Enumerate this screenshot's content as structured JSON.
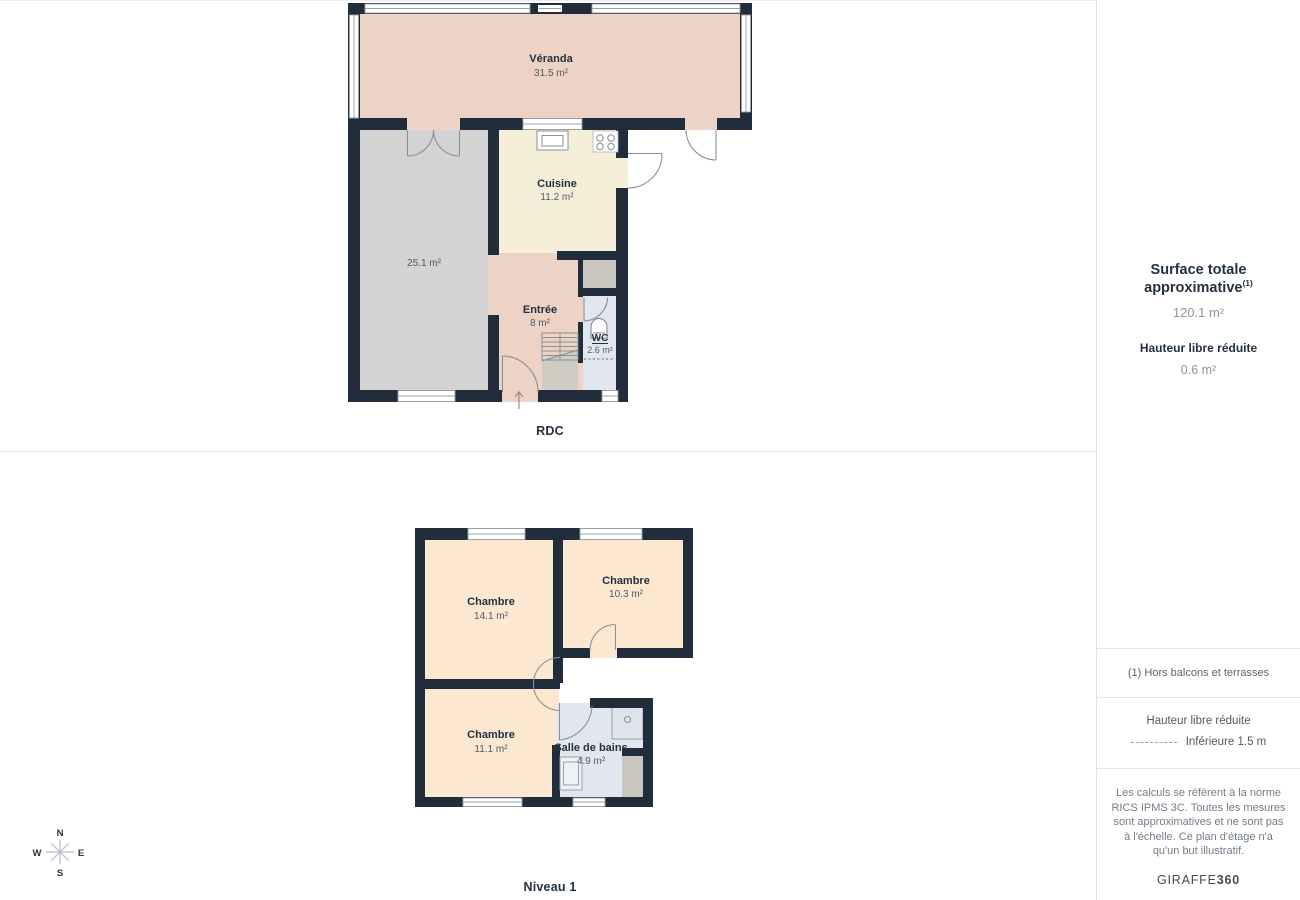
{
  "floors": {
    "rdc": {
      "label": "RDC",
      "rooms": {
        "veranda": {
          "name": "Véranda",
          "area": "31.5 m²"
        },
        "cuisine": {
          "name": "Cuisine",
          "area": "11.2 m²"
        },
        "living": {
          "area": "25.1 m²"
        },
        "entree": {
          "name": "Entrée",
          "area": "8 m²"
        },
        "wc": {
          "name": "WC",
          "area": "2.6 m²"
        }
      }
    },
    "niveau1": {
      "label": "Niveau 1",
      "rooms": {
        "chambre_a": {
          "name": "Chambre",
          "area": "14.1 m²"
        },
        "chambre_b": {
          "name": "Chambre",
          "area": "10.3 m²"
        },
        "chambre_c": {
          "name": "Chambre",
          "area": "11.1 m²"
        },
        "salle_de_bains": {
          "name": "Salle de bains",
          "area": "4.9 m²"
        }
      }
    }
  },
  "compass": {
    "north": "N",
    "east": "E",
    "south": "S",
    "west": "W"
  },
  "sidebar": {
    "surface_title": "Surface totale approximative",
    "surface_sup": "(1)",
    "surface_value": "120.1 m²",
    "hauteur_title": "Hauteur libre réduite",
    "hauteur_value": "0.6 m²",
    "footnote": "(1) Hors balcons et terrasses",
    "legend_title": "Hauteur libre réduite",
    "legend_value": "Inférieure 1.5 m",
    "disclaimer": "Les calculs se réfèrent à la norme RICS IPMS 3C. Toutes les mesures sont approximatives et ne sont pas à l'échelle. Ce plan d'étage n'a qu'un but illustratif.",
    "brand_normal": "GIRAFFE",
    "brand_bold": "360"
  },
  "colors": {
    "wall": "#212d3a",
    "veranda_pink": "#edd3c6",
    "cuisine_cream": "#f5eed8",
    "living_gray": "#d3d3d3",
    "wc_blue": "#e2e6ee",
    "chambre_peach": "#fce8d0",
    "closet_gray": "#c9c5bf",
    "understairs_gray": "#cfccc6",
    "shower_gray": "#dfe3ea",
    "label_navy": "#233140"
  }
}
